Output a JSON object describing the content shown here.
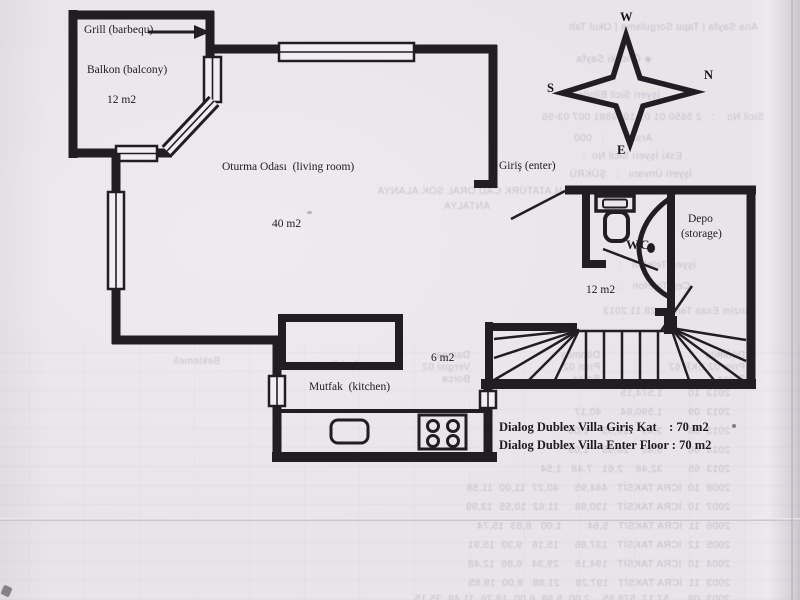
{
  "plan": {
    "rooms": {
      "grill": {
        "label": "Grill (barbequ)"
      },
      "balcony": {
        "label": "Balkon (balcony)",
        "area": "12 m2"
      },
      "living_room": {
        "label": "Oturma Odası  (living room)",
        "area": "40 m2"
      },
      "entrance": {
        "label": "Giriş (enter)"
      },
      "wc": {
        "label": "WC"
      },
      "storage": {
        "label": "Depo",
        "label2": "(storage)"
      },
      "hall": {
        "area": "12 m2"
      },
      "corridor": {
        "area": "6 m2"
      },
      "kitchen": {
        "label": "Mutfak  (kitchen)"
      }
    },
    "compass": {
      "w": "W",
      "s": "S",
      "n": "N",
      "e": "E"
    },
    "titles": {
      "line1": "Dialog Dublex Villa Giriş Kat    : 70 m2",
      "line2": "Dialog Dublex Villa Enter Floor : 70 m2"
    }
  },
  "colors": {
    "ink": "#201e20",
    "paper": "#e7e4e8",
    "bleed": "#a29bb3"
  },
  "bleedthrough": {
    "items": [
      {
        "x": 42,
        "y": 22,
        "text": "Ana Sayfa | Tapu Sorgulama | Okul Tah"
      },
      {
        "x": 148,
        "y": 54,
        "text": "◈ Önceki Sayfa"
      },
      {
        "x": 140,
        "y": 90,
        "text": "İşyeri Sicil Bilgileri"
      },
      {
        "x": 36,
        "y": 112,
        "text": "Sicil No    :   2 5650 01 01 1039881 007 03-96"
      },
      {
        "x": 148,
        "y": 133,
        "text": "Arsa        :   000"
      },
      {
        "x": 118,
        "y": 151,
        "text": "Eski İşyeri Sicil No  :"
      },
      {
        "x": 108,
        "y": 169,
        "text": "İşyeri Ünvanı   :   ŞÜKRÜ"
      },
      {
        "x": 222,
        "y": 186,
        "text": "MAH.ATATÜRK CAD.ORAL SOK.ALANYA"
      },
      {
        "x": 310,
        "y": 201,
        "text": "ANTALYA"
      },
      {
        "x": 104,
        "y": 260,
        "text": "İşyeri Telefon   :"
      },
      {
        "x": 110,
        "y": 281,
        "text": "Cep Telefon   :"
      },
      {
        "x": 44,
        "y": 306,
        "text": "Tanzim Esas Tarihi : 28.11.2013"
      },
      {
        "x": 55,
        "y": 350,
        "text": "Dönmüş"
      },
      {
        "x": 55,
        "y": 362,
        "text": "Prim 02 EKP 62"
      },
      {
        "x": 55,
        "y": 374,
        "text": "Borca"
      },
      {
        "x": 200,
        "y": 350,
        "text": "Dönmüş"
      },
      {
        "x": 200,
        "y": 362,
        "text": "Prim 02"
      },
      {
        "x": 200,
        "y": 374,
        "text": "Borca"
      },
      {
        "x": 330,
        "y": 350,
        "text": "Damga"
      },
      {
        "x": 330,
        "y": 362,
        "text": "Vergisi 02"
      },
      {
        "x": 330,
        "y": 374,
        "text": "Borca"
      },
      {
        "x": 440,
        "y": 360,
        "text": "Ay | Durumu"
      },
      {
        "x": 580,
        "y": 356,
        "text": "Beklemeli"
      },
      {
        "x": 70,
        "y": 348,
        "text": "Yıl"
      },
      {
        "x": 70,
        "y": 388,
        "text": "2013  10        1.574,15"
      },
      {
        "x": 70,
        "y": 407,
        "text": "2013  09        1.590,64      40,17"
      },
      {
        "x": 70,
        "y": 426,
        "text": "2013  08        3,49    19,55    1,00"
      },
      {
        "x": 70,
        "y": 445,
        "text": "2013  06        8,40    20,55    1,09"
      },
      {
        "x": 70,
        "y": 464,
        "text": "2013  65        32,48    2,61   7,48   1,54"
      },
      {
        "x": 70,
        "y": 483,
        "text": "2008  10  İCRA TAKSİT   444,95     40,27  11,00  11,58"
      },
      {
        "x": 70,
        "y": 502,
        "text": "2007  10  İCRA TAKSİT   130,98     11,62  10,55  13,99"
      },
      {
        "x": 70,
        "y": 521,
        "text": "2006  11  İCRA TAKSİT   5,64        1,00   8,83  15,74"
      },
      {
        "x": 70,
        "y": 540,
        "text": "2005  12  İCRA TAKSİT   137,86     15,16   9,30  15,91"
      },
      {
        "x": 70,
        "y": 559,
        "text": "2004  10  İCRA TAKSİT   194,16     29,34   6,86  12,48"
      },
      {
        "x": 70,
        "y": 578,
        "text": "2003  11  İCRA TAKSİT   197,28     21,88   8,00  18,85"
      },
      {
        "x": 70,
        "y": 594,
        "text": "2003  09      57,17  578,85    2,00  5,98  6,00  18,76  11,48  35,15"
      }
    ]
  }
}
